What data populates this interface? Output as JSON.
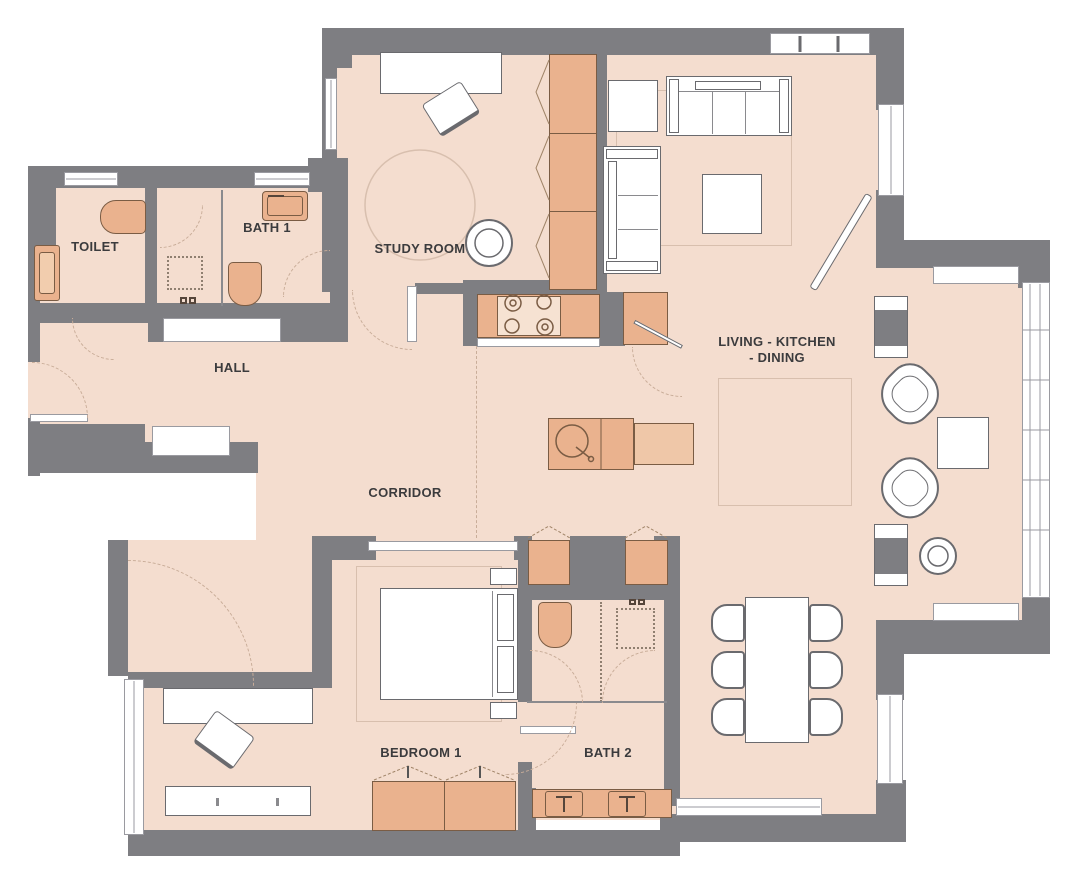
{
  "colors": {
    "wall": "#7E7E82",
    "floor": "#F4DDCF",
    "furn": "#EAB28E",
    "furnlight": "#EFC7A8",
    "oline": "#7a5c44",
    "label": "#3B3B3D",
    "rug": "#d8bfae"
  },
  "rooms": {
    "toilet": {
      "label": "TOILET"
    },
    "bath1": {
      "label": "BATH 1"
    },
    "hall": {
      "label": "HALL"
    },
    "study": {
      "label": "STUDY ROOM"
    },
    "corridor": {
      "label": "CORRIDOR"
    },
    "living": {
      "label_line1": "LIVING - KITCHEN",
      "label_line2": "- DINING"
    },
    "bedroom1": {
      "label": "BEDROOM 1"
    },
    "bath2": {
      "label": "BATH 2"
    }
  }
}
